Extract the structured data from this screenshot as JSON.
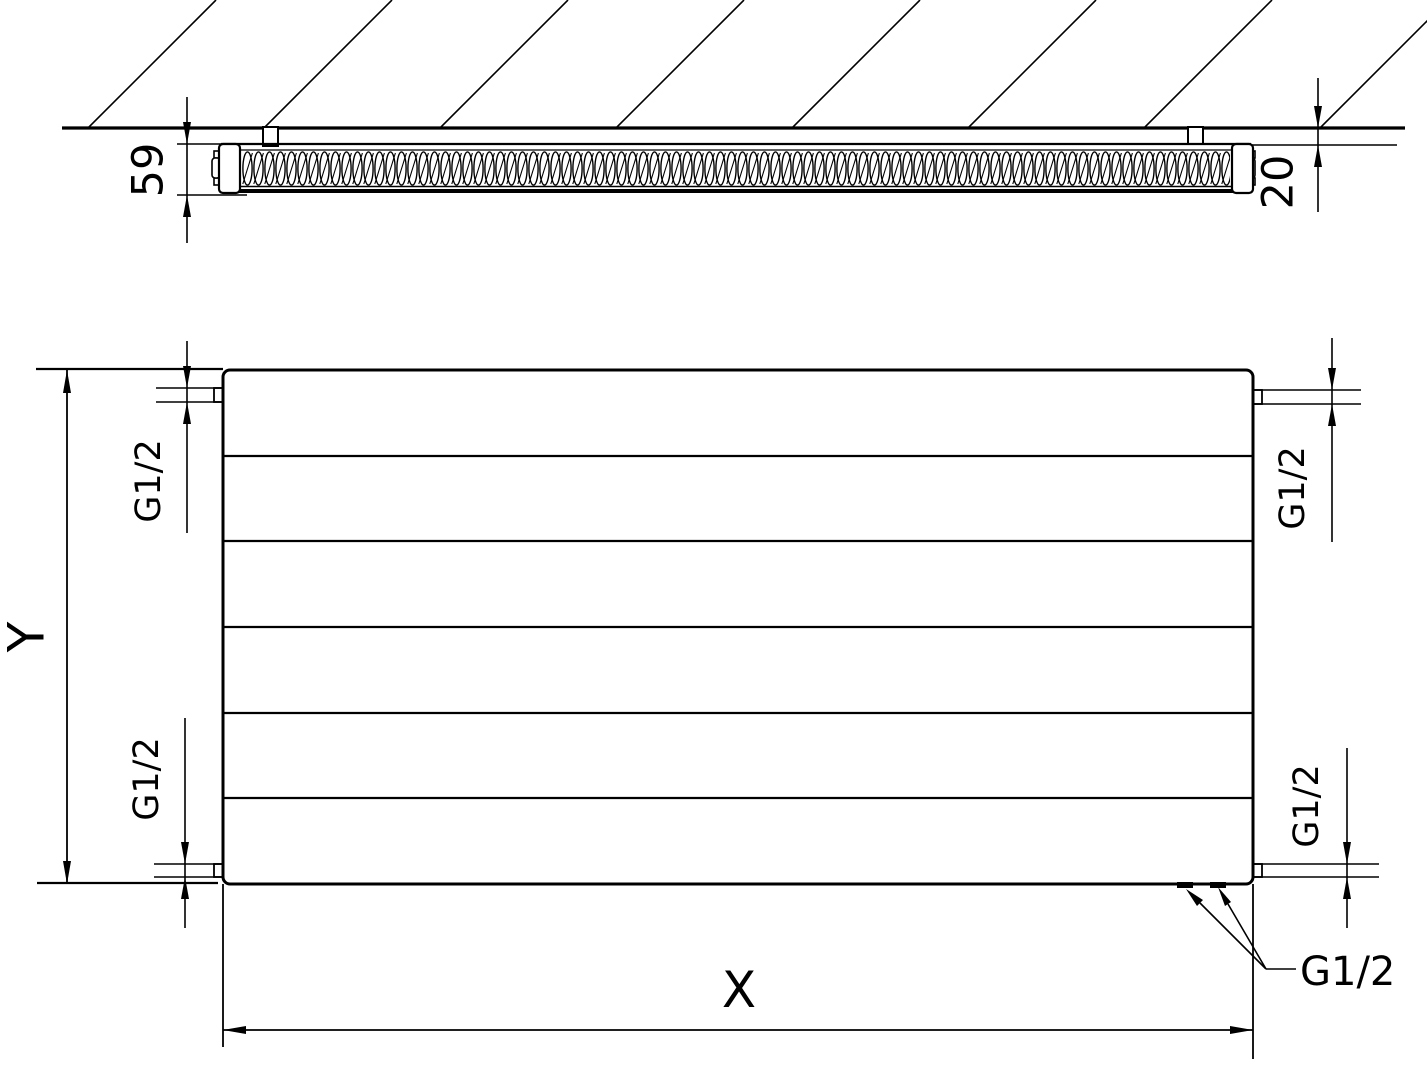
{
  "figure": {
    "kind": "radiator technical dimension drawing",
    "views": [
      "wall cross-section (top)",
      "front view (bottom)"
    ],
    "colors": {
      "background": "#ffffff",
      "line": "#000000"
    }
  },
  "cross_section_view": {
    "depth_dim": "59",
    "wall_gap_dim": "20"
  },
  "front_view": {
    "height_dim": "Y",
    "width_dim": "X",
    "panel_sections": 6,
    "port_dims": {
      "top_left": "G1/2",
      "top_right": "G1/2",
      "bottom_left": "G1/2",
      "bottom_right": "G1/2"
    },
    "bottom_connections_callout": "G1/2"
  }
}
